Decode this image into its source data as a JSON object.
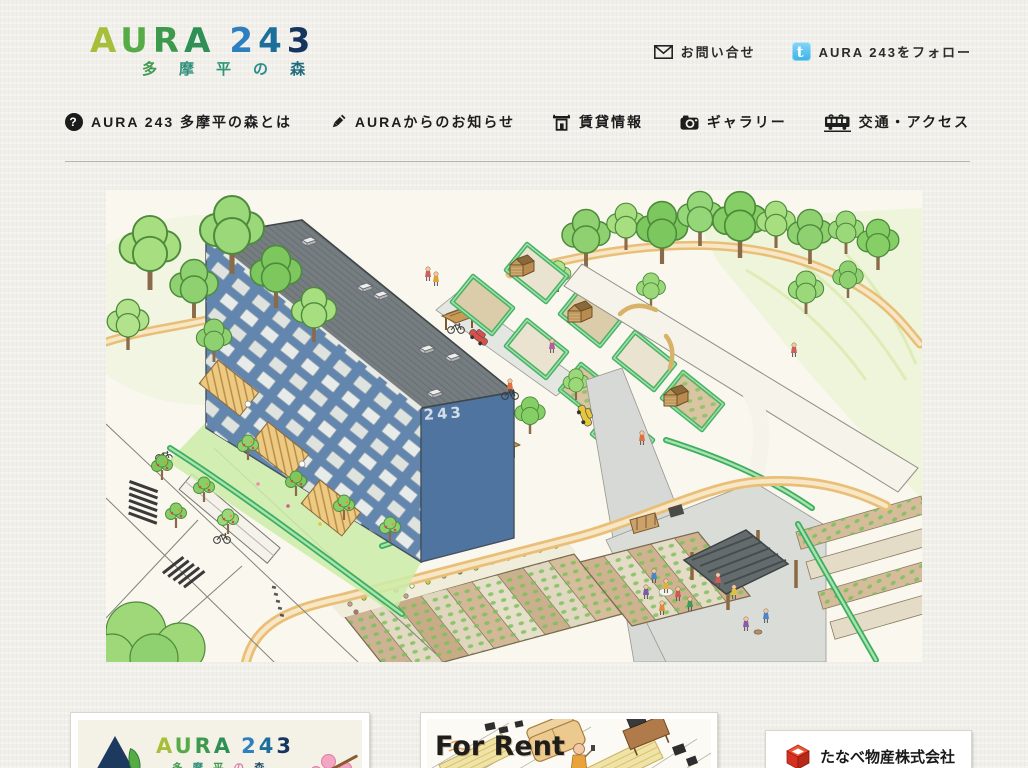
{
  "colors": {
    "page_bg": "#f0efe9",
    "twitter_blue": "#38b2e8",
    "hedge_green": "#3fae62",
    "building_blue": "#6286ad",
    "roof_gray": "#757d80",
    "path_tan": "#e9bf78",
    "logo_navy": "#16355e"
  },
  "header": {
    "logo": {
      "word1": [
        {
          "ch": "A",
          "color": "#a6bf3a"
        },
        {
          "ch": "U",
          "color": "#57ab47"
        },
        {
          "ch": "R",
          "color": "#3d9a4c"
        },
        {
          "ch": "A",
          "color": "#2f9055"
        }
      ],
      "word2": [
        {
          "ch": "2",
          "color": "#2e7fc0"
        },
        {
          "ch": "4",
          "color": "#1d6f9b"
        },
        {
          "ch": "3",
          "color": "#16355e"
        }
      ],
      "subtitle": [
        {
          "ch": "多",
          "color": "#3e9a4f"
        },
        {
          "ch": "摩",
          "color": "#2e8f7a"
        },
        {
          "ch": "平",
          "color": "#2f9577"
        },
        {
          "ch": "の",
          "color": "#2b8c8c"
        },
        {
          "ch": "森",
          "color": "#1e6b7d"
        }
      ]
    },
    "contact_label": "お問い合せ",
    "follow_label": "AURA 243をフォロー"
  },
  "nav": {
    "items": [
      {
        "id": "about",
        "label": "AURA 243 多摩平の森とは",
        "icon": "question-icon"
      },
      {
        "id": "news",
        "label": "AURAからのお知らせ",
        "icon": "pencil-icon"
      },
      {
        "id": "rent",
        "label": "賃貸情報",
        "icon": "building-icon"
      },
      {
        "id": "gallery",
        "label": "ギャラリー",
        "icon": "camera-icon"
      },
      {
        "id": "access",
        "label": "交通・アクセス",
        "icon": "train-icon"
      }
    ]
  },
  "hero": {
    "building_number": "243"
  },
  "banners": {
    "aura": {
      "subtitle": [
        {
          "ch": "多",
          "color": "#3e9a4f"
        },
        {
          "ch": "摩",
          "color": "#2e8f7a"
        },
        {
          "ch": "平",
          "color": "#3d9a4c"
        },
        {
          "ch": "の",
          "color": "#e07ba8"
        },
        {
          "ch": "森",
          "color": "#1e4b66"
        }
      ]
    },
    "for_rent": {
      "label": "For Rent"
    },
    "tanabe": {
      "label": "たなべ物産株式会社"
    }
  },
  "icons": {
    "question": "?",
    "twitter_glyph": "t"
  }
}
